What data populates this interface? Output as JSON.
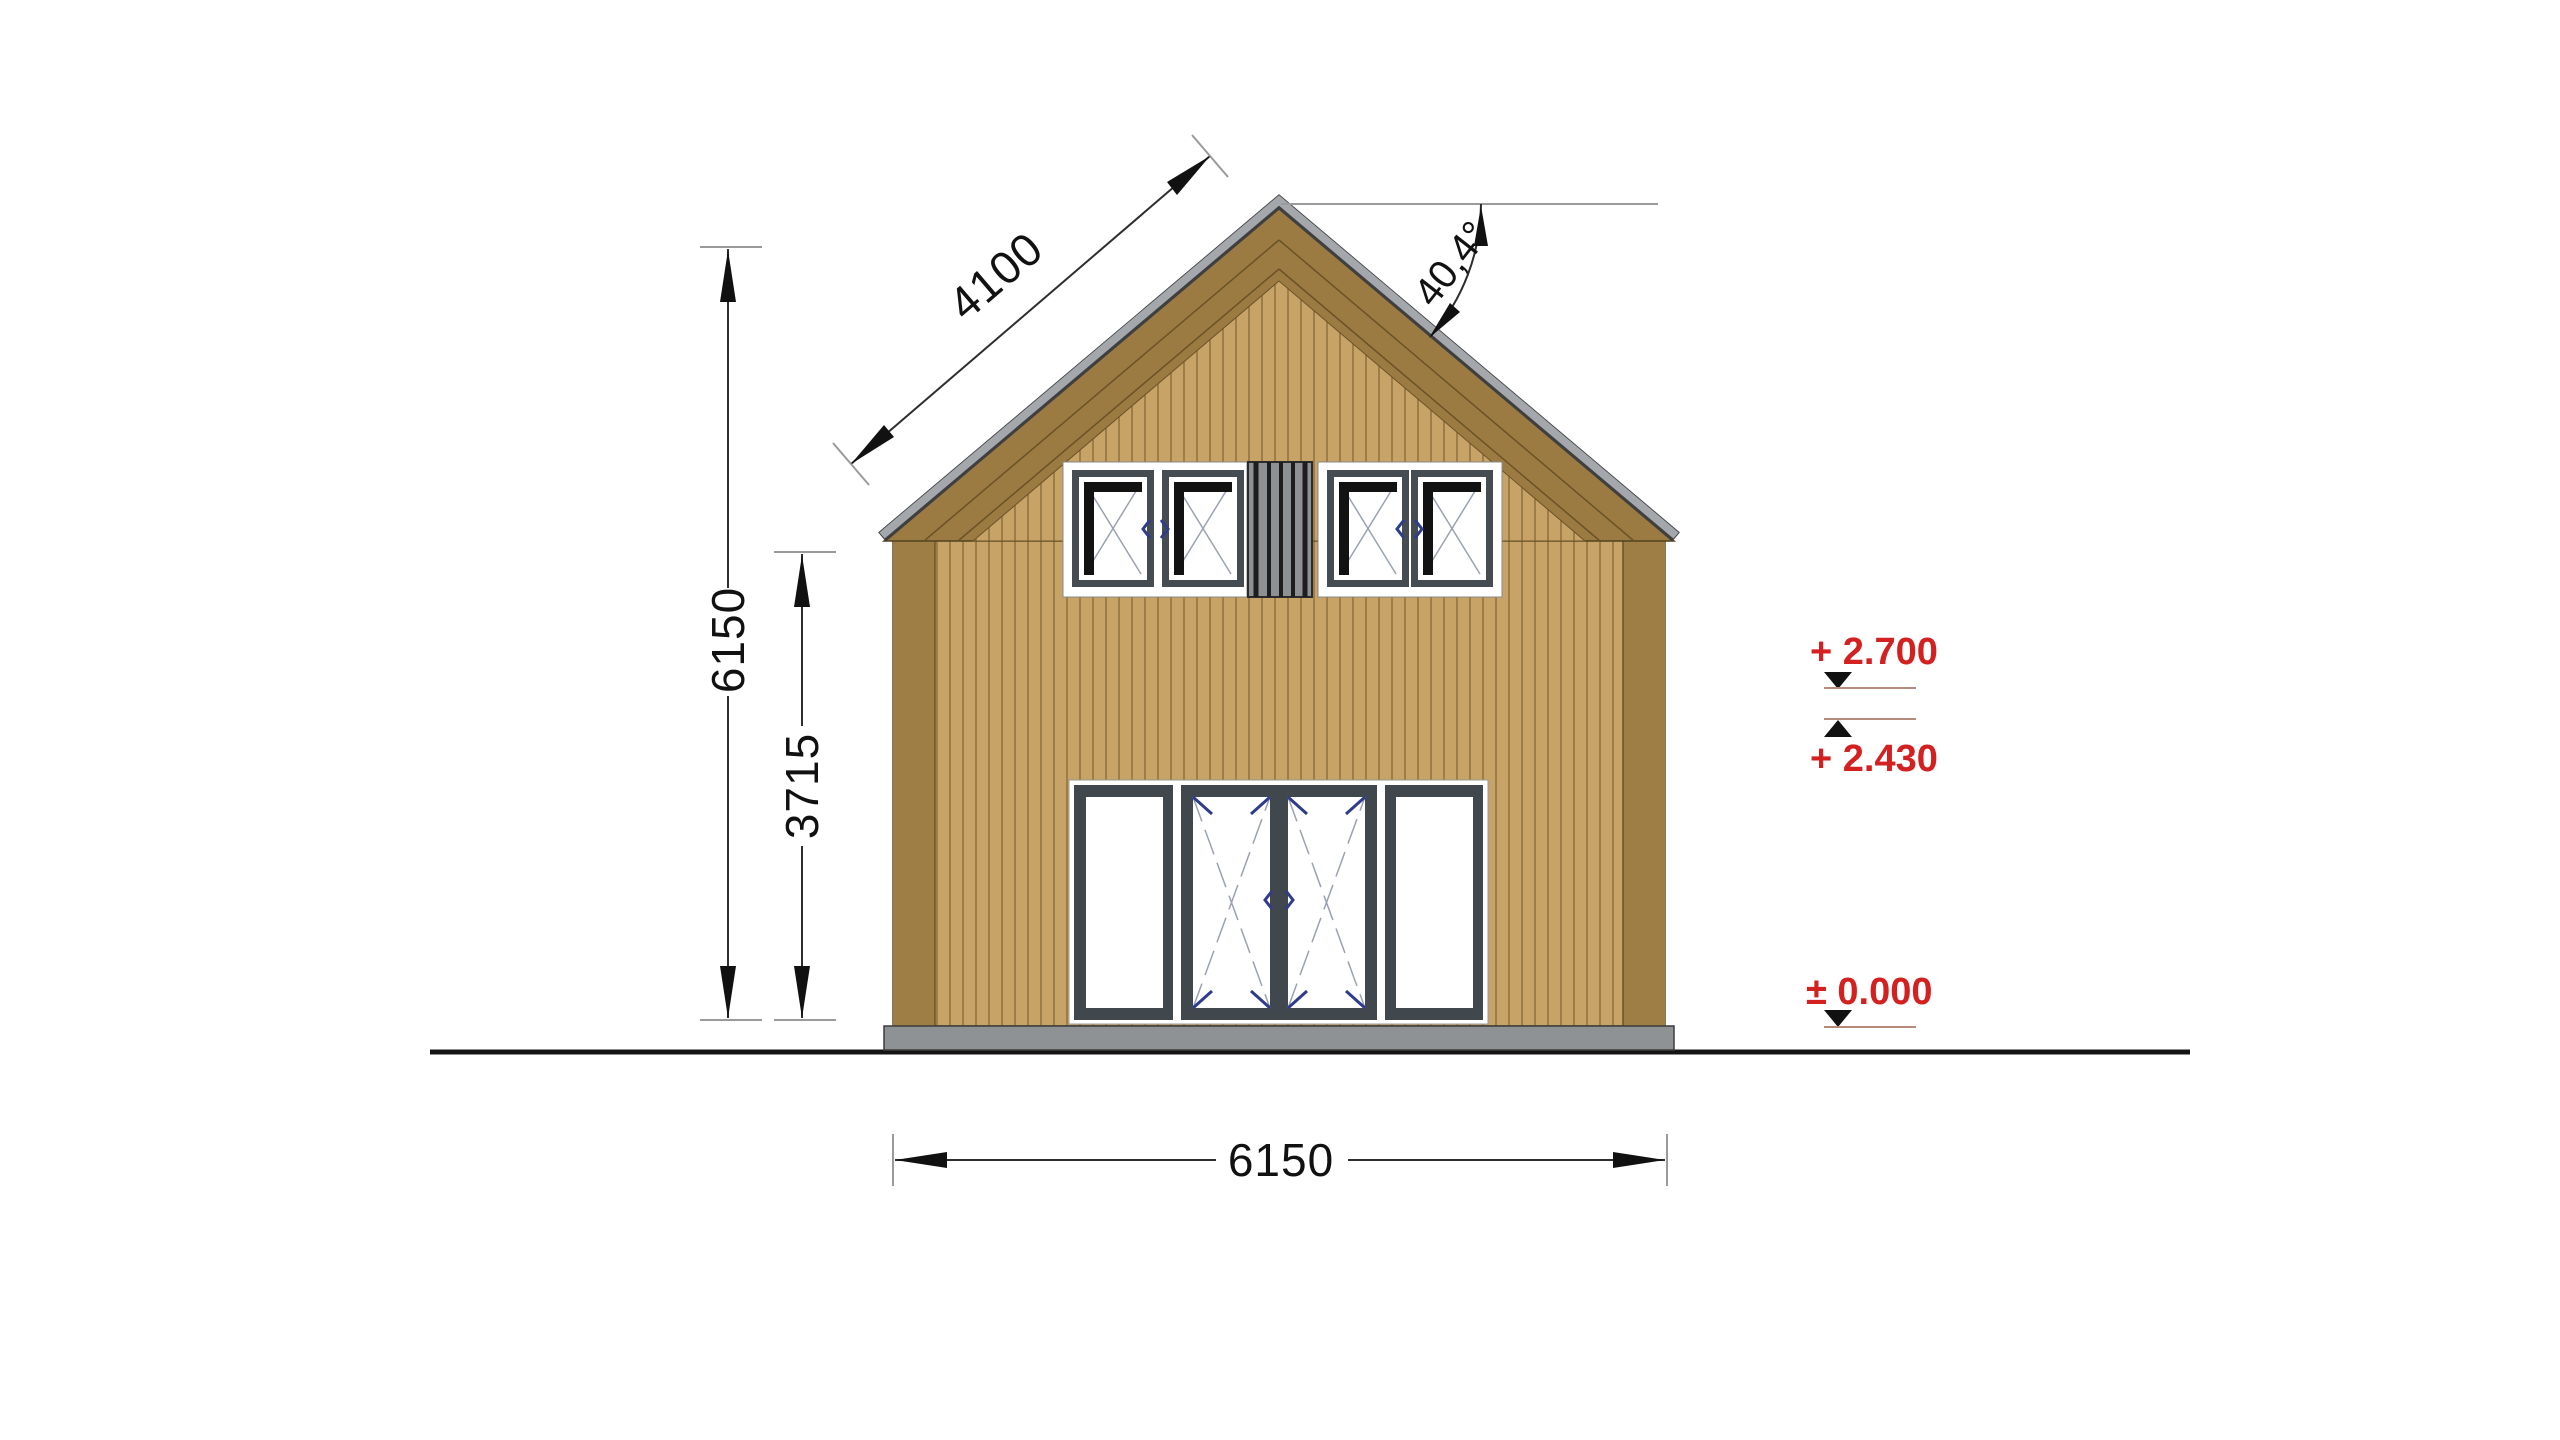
{
  "drawing": {
    "title": "house-front-elevation",
    "dims": {
      "roof_slope": "4100",
      "total_height": "6150",
      "wall_height": "3715",
      "width": "6150",
      "roof_angle": "40,4°"
    },
    "levels": [
      {
        "id": "ridge-level",
        "label": "+ 2.700"
      },
      {
        "id": "eave-level",
        "label": "+ 2.430"
      },
      {
        "id": "ground-level",
        "label": "± 0.000"
      }
    ],
    "colors": {
      "level_red": "#d32020",
      "siding": "#c8a368",
      "fascia": "#9c7b43",
      "corner_board": "#9f7e45",
      "frame_dark": "#454c52",
      "ridge_cap": "#a4a8ac",
      "foundation": "#8f9294"
    }
  }
}
